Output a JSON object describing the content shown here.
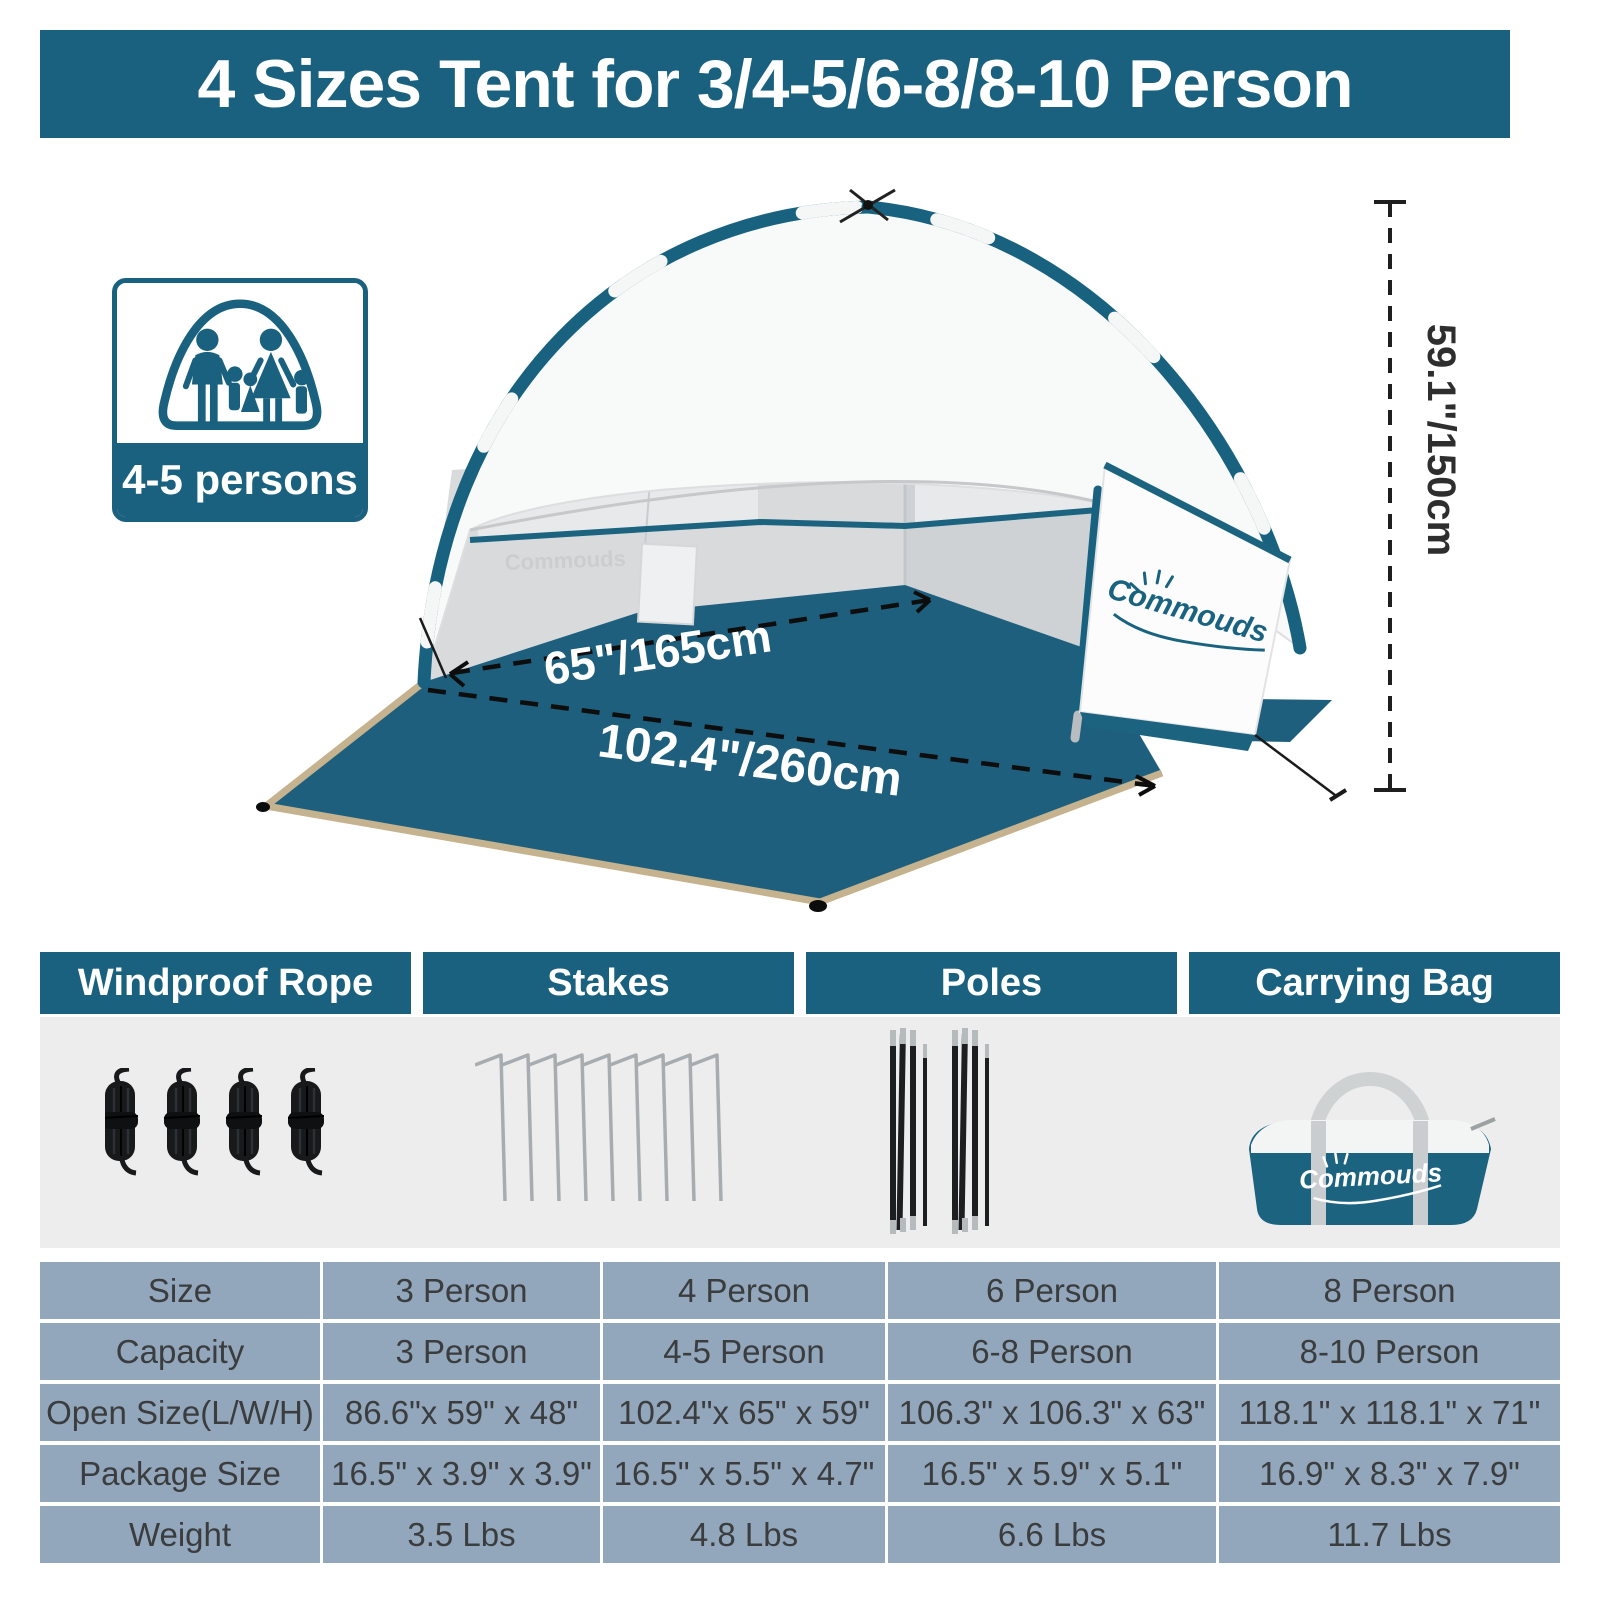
{
  "banner": {
    "title": "4 Sizes Tent for 3/4-5/6-8/8-10 Person"
  },
  "capacity_badge": {
    "label": "4-5 persons",
    "icon": "family-in-tent-icon"
  },
  "tent": {
    "brand": "Commouds",
    "wall_watermark": "Commouds",
    "dim_front_width": "65\"/165cm",
    "dim_total_width": "102.4\"/260cm",
    "dim_height": "59.1\"/150cm"
  },
  "components": {
    "items": [
      {
        "label": "Windproof Rope",
        "icon": "rope-coils-icon"
      },
      {
        "label": "Stakes",
        "icon": "stakes-icon"
      },
      {
        "label": "Poles",
        "icon": "poles-icon"
      },
      {
        "label": "Carrying Bag",
        "icon": "carrying-bag-icon",
        "bag_logo": "Commouds"
      }
    ]
  },
  "spec_table": {
    "rows": [
      [
        "Size",
        "3 Person",
        "4 Person",
        "6 Person",
        "8 Person"
      ],
      [
        "Capacity",
        "3 Person",
        "4-5 Person",
        "6-8 Person",
        "8-10 Person"
      ],
      [
        "Open Size(L/W/H)",
        "86.6\"x 59\" x 48\"",
        "102.4\"x 65\" x 59\"",
        "106.3\" x 106.3\" x 63\"",
        "118.1\" x 118.1\" x 71\""
      ],
      [
        "Package Size",
        "16.5\" x 3.9\" x 3.9\"",
        "16.5\" x 5.5\" x 4.7\"",
        "16.5\" x 5.9\" x 5.1\"",
        "16.9\" x 8.3\" x 7.9\""
      ],
      [
        "Weight",
        "3.5 Lbs",
        "4.8 Lbs",
        "6.6 Lbs",
        "11.7 Lbs"
      ]
    ]
  },
  "colors": {
    "accent_teal": "#19617E",
    "floor_teal": "#1D5F7D",
    "table_cell": "#92A7BC",
    "panel_gray": "#EDEDEE",
    "trim_tan": "#C5B28E"
  }
}
